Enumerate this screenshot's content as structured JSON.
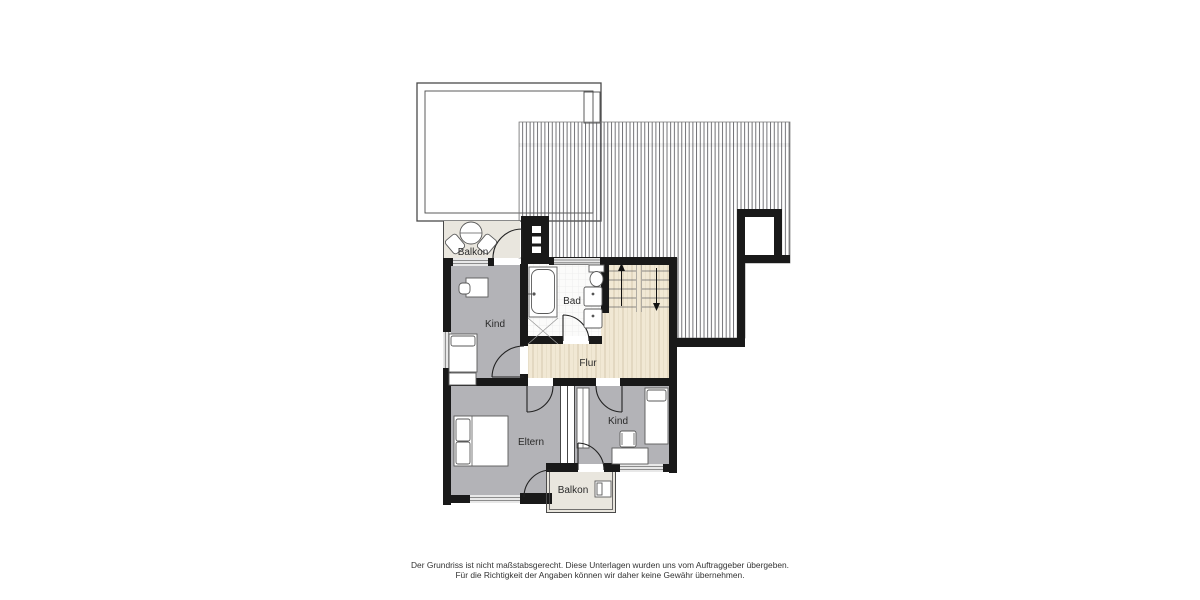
{
  "plan": {
    "rooms": {
      "balkon_top": "Balkon",
      "kind_left": "Kind",
      "bad": "Bad",
      "flur": "Flur",
      "eltern": "Eltern",
      "kind_right": "Kind",
      "balkon_bottom": "Balkon"
    },
    "furniture_icons": [
      "round-table-icon",
      "chair-icon",
      "desk-icon",
      "single-bed-icon",
      "double-bed-icon",
      "bathtub-icon",
      "shower-icon",
      "toilet-icon",
      "washbasin-icon",
      "wardrobe-icon",
      "staircase-icon",
      "balcony-chair-icon"
    ]
  },
  "footer": {
    "line1": "Der Grundriss ist nicht maßstabsgerecht. Diese Unterlagen wurden uns vom Auftraggeber übergeben.",
    "line2": "Für die Richtigkeit der Angaben können wir daher keine Gewähr übernehmen."
  },
  "colors": {
    "wall": "#191919",
    "room_gray": "#b3b3b7",
    "wood_beige": "#f1e8d4",
    "balcony_floor": "#e9e6de",
    "bath_floor": "#fbfbfa",
    "outline": "#4a4a4a"
  }
}
